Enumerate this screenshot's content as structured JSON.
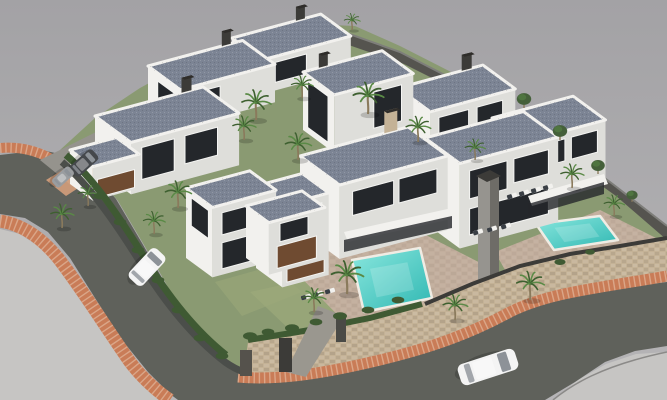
{
  "scene": {
    "description": "Aerial 3D architectural rendering of a modern residential development: nine white flat-roofed villas with dark blue-gray roofs, palm trees, two turquoise swimming pools on raised stone-walled terraces, brick-edged asphalt roads curving around the lower-left and bottom of the compound, a white van on the west road, a white car on the south road, and parked vehicles at the north entrance",
    "type": "3D architectural rendering",
    "view": "aerial three-quarter perspective",
    "objects": {
      "villas": 9,
      "swimming_pools": 2,
      "palm_trees": 17,
      "round_trees": 4,
      "vehicles": 4
    },
    "vehicle_labels": [
      "white-van-west-road",
      "white-car-south-road",
      "dark-van-entrance",
      "gray-car-entrance"
    ]
  },
  "palette": {
    "bgTop": "#a3a2a5",
    "bgBottom": "#b6b5b7",
    "pavement": "#c6c5c3",
    "road": "#5f615b",
    "brick": "#c97c57",
    "brickLight": "#daa27e",
    "mortar": "#efd9c6",
    "terrain": "#8a9a72",
    "grassLight": "#9caa7a",
    "stone": "#c4b296",
    "stoneShade": "#a5947a",
    "darkWall": "#55544f",
    "wallCap": "#3c3b38",
    "villaLit": "#f2f1ee",
    "villaMid": "#dededa",
    "villaShade": "#c9c9c5",
    "roof": "#7c8494",
    "roofLight": "#9aa2b0",
    "glass": "#24272b",
    "frame": "#f4f4f2",
    "wood": "#6f4b31",
    "poolLight": "#8ae7de",
    "poolDeep": "#2fb7b2",
    "terrace": "#c2ae9d",
    "hedge": "#3f5a33",
    "palm": "#5a8a46",
    "palmDark": "#3e6030",
    "treeDark": "#45603a",
    "trunk": "#8a7a5c",
    "vehicleWhite": "#f4f4f4",
    "vehicleGlass": "#8d9298",
    "vehicleDark": "#45484c",
    "vehicleGray": "#9a9da0",
    "concrete": "#95938d",
    "towerLit": "#96948f",
    "towerShade": "#6e6c67"
  }
}
